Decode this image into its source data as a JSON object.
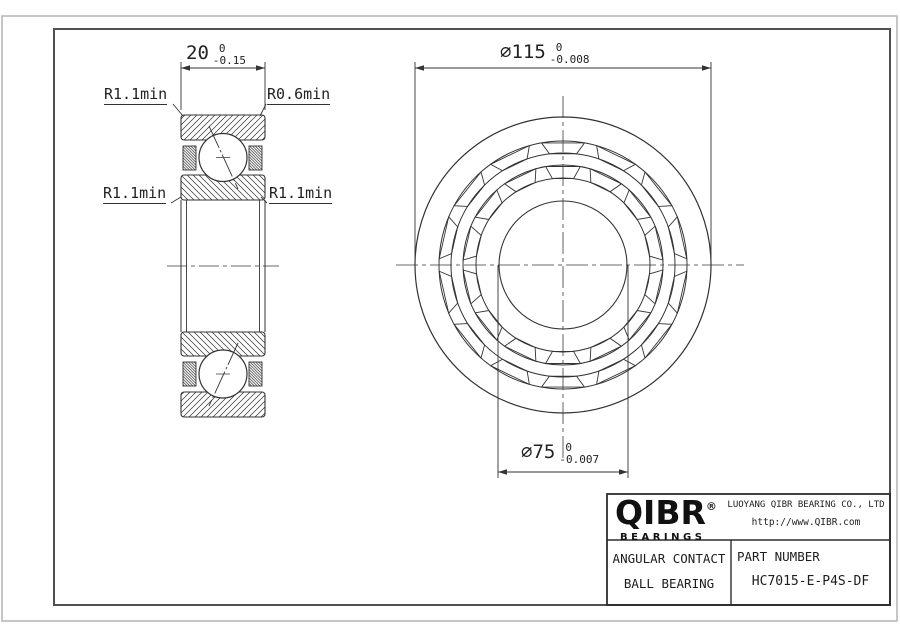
{
  "dimensions": {
    "width": {
      "value": "20",
      "tol_upper": "0",
      "tol_lower": "-0.15"
    },
    "outer_diameter": {
      "value": "⌀115",
      "tol_upper": "0",
      "tol_lower": "-0.008"
    },
    "bore_diameter": {
      "value": "⌀75",
      "tol_upper": "0",
      "tol_lower": "-0.007"
    }
  },
  "radius_labels": {
    "top_left": "R1.1min",
    "top_right": "R0.6min",
    "mid_left": "R1.1min",
    "mid_right": "R1.1min"
  },
  "title_block": {
    "logo_name": "QIBR",
    "logo_registered": "®",
    "logo_tagline": "BEARINGS",
    "company": "LUOYANG QIBR BEARING CO., LTD",
    "website": "http://www.QIBR.com",
    "product_line1": "ANGULAR CONTACT",
    "product_line2": "BALL BEARING",
    "part_number_label": "PART NUMBER",
    "part_number": "HC7015-E-P4S-DF"
  },
  "colors": {
    "line": "#333333",
    "frame_outer": "#b3b3b3",
    "frame_inner": "#4f4f4f",
    "text": "#222222"
  }
}
